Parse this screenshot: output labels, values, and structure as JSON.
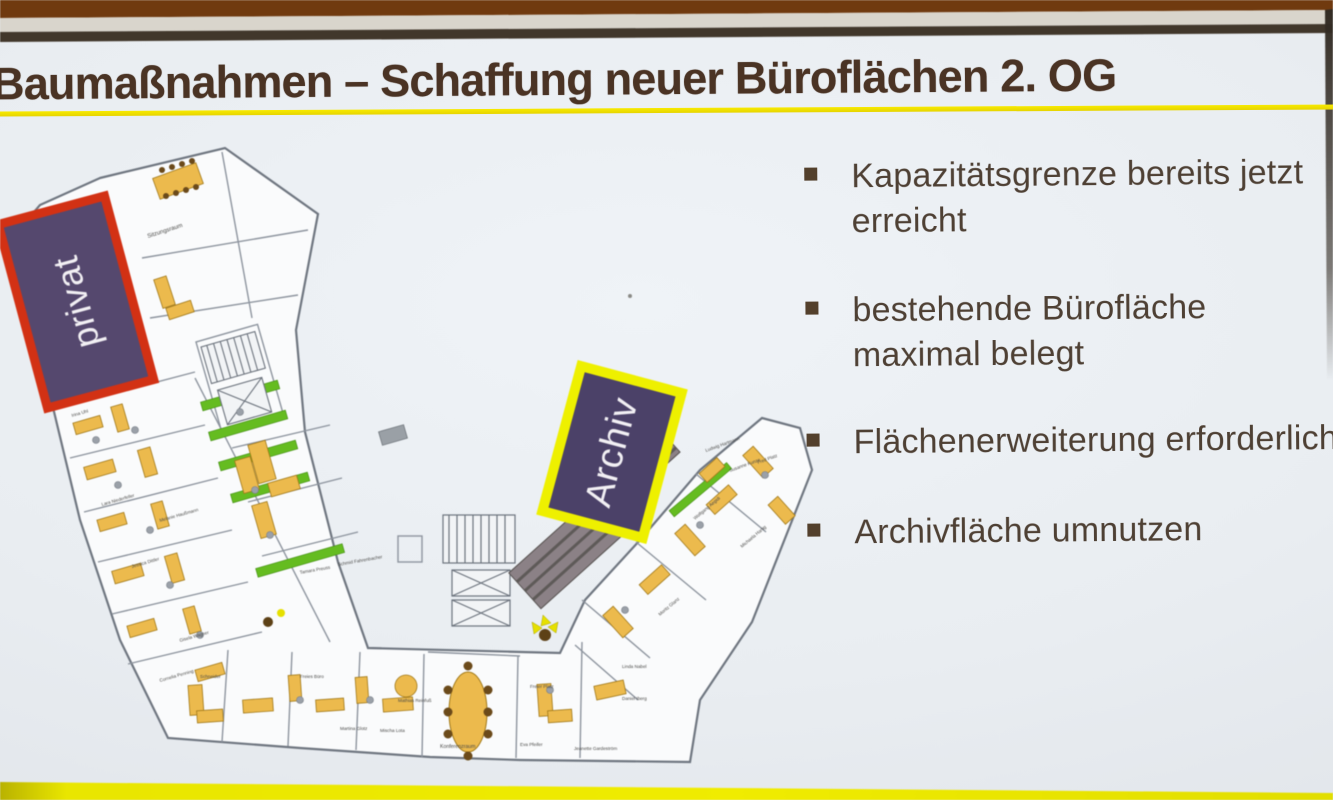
{
  "slide": {
    "title": "Baumaßnahmen – Schaffung neuer Büroflächen 2. OG",
    "title_color": "#4a3324",
    "underline_color": "#f0e000",
    "background_color": "#e9edf1",
    "bullets": [
      {
        "lines": [
          "Kapazitätsgrenze bereits jetzt",
          "erreicht"
        ]
      },
      {
        "lines": [
          "bestehende Bürofläche",
          "maximal belegt"
        ]
      },
      {
        "lines": [
          "Flächenerweiterung erforderlich"
        ]
      },
      {
        "lines": [
          "Archivfläche umnutzen"
        ]
      }
    ],
    "bullet_color": "#53402c",
    "text_color": "#4e4034",
    "bottom_band_color": "#ece900"
  },
  "photo_frame": {
    "top_wall_color": "#703a0f",
    "screen_top_strip_color": "#d9d5cc",
    "screen_top_line_color": "#41372b",
    "right_edge_color": "#332c24"
  },
  "floor_plan": {
    "drawing_label": "CC 2. OG",
    "overlays": [
      {
        "label": "privat",
        "fill": "#55486e",
        "border": "#d23114"
      },
      {
        "label": "Archiv",
        "fill": "#4b4168",
        "border": "#eef000"
      }
    ],
    "colors": {
      "desk": "#ecba4d",
      "green_strip": "#65bc20",
      "archive_shelving": "#8b8186",
      "walls": "#8d949e",
      "floor": "#fafbfc"
    },
    "room_labels": [
      {
        "text": "Sitzungsraum"
      },
      {
        "text": "Irina Uhl"
      },
      {
        "text": "Lara Niederfeller"
      },
      {
        "text": "Melanie Haußmann"
      },
      {
        "text": "Jessica Dittler"
      },
      {
        "text": "Gisela Wagner"
      },
      {
        "text": "Cornelia Penning"
      },
      {
        "text": "Tamara Preuss"
      },
      {
        "text": "Schmid Fahrenbacher"
      },
      {
        "text": "Schneider"
      },
      {
        "text": "Freies Büro"
      },
      {
        "text": "Martina Glotz"
      },
      {
        "text": "Mischa Lota"
      },
      {
        "text": "Mathias Reinfuß"
      },
      {
        "text": "Konferenzraum"
      },
      {
        "text": "Freier Platz"
      },
      {
        "text": "Eva Pfeifer"
      },
      {
        "text": "Jeanette Gardeström"
      },
      {
        "text": "Daniel Iberg"
      },
      {
        "text": "Linda Nabel"
      },
      {
        "text": "Moritz Glanz"
      },
      {
        "text": "Wolfgang Aegidi"
      },
      {
        "text": "Ludwig Hartmann"
      },
      {
        "text": "Susanne Kunze"
      },
      {
        "text": "Fred Platz"
      },
      {
        "text": "Michaela Hartig"
      }
    ]
  }
}
